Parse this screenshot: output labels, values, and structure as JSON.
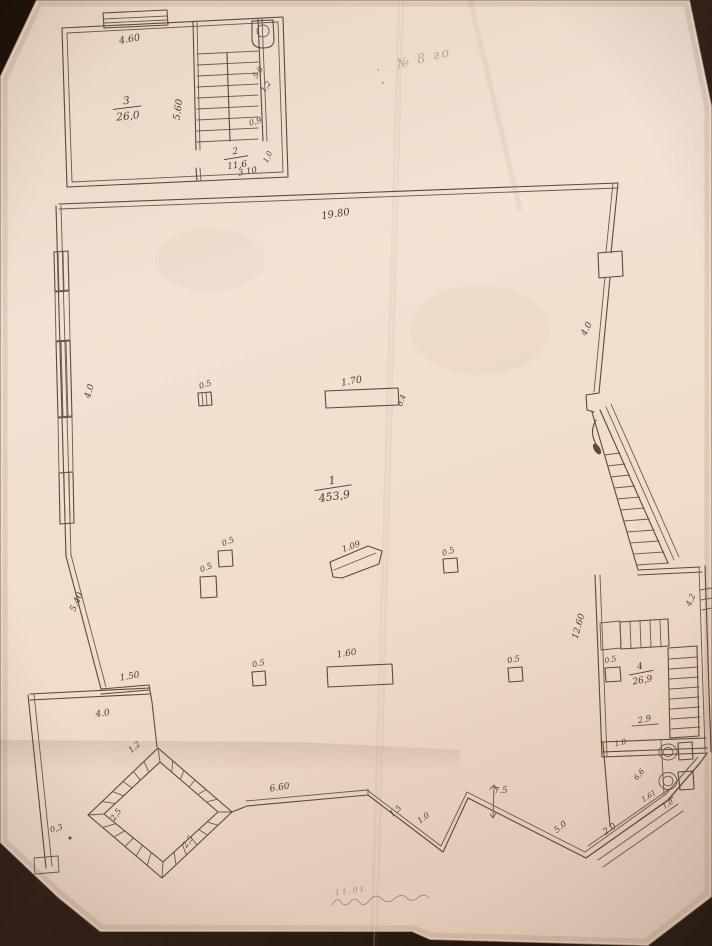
{
  "photo": {
    "background_color": "#281a11",
    "paper_color": "#eeddcd",
    "ink_color": "#5a493c",
    "pencil_color": "#4c3c30"
  },
  "rooms": [
    {
      "number": "3",
      "area": "26,0",
      "x": 127,
      "y": 107,
      "rot": -6,
      "size": 10.5
    },
    {
      "number": "2",
      "area": "11,6",
      "x": 236,
      "y": 157,
      "rot": -8,
      "size": 9
    },
    {
      "number": "1",
      "area": "453,9",
      "x": 333,
      "y": 487,
      "rot": -8,
      "size": 11
    },
    {
      "number": "4",
      "area": "26,9",
      "x": 641,
      "y": 672,
      "rot": -10,
      "size": 9
    }
  ],
  "dimensions": [
    {
      "text": "4.60",
      "x": 130,
      "y": 42,
      "rot": -10,
      "size": 9.5
    },
    {
      "text": "5.60",
      "x": 181,
      "y": 110,
      "rot": -82,
      "size": 9.5
    },
    {
      "text": "5,0",
      "x": 260,
      "y": 74,
      "rot": -55,
      "size": 7.5
    },
    {
      "text": "1,2",
      "x": 268,
      "y": 88,
      "rot": -55,
      "size": 7.5
    },
    {
      "text": "0,9",
      "x": 256,
      "y": 124,
      "rot": -18,
      "size": 8
    },
    {
      "text": "1,0",
      "x": 270,
      "y": 158,
      "rot": -65,
      "size": 7.5
    },
    {
      "text": "3.10",
      "x": 248,
      "y": 174,
      "rot": -10,
      "size": 8.5
    },
    {
      "text": "19.80",
      "x": 336,
      "y": 217,
      "rot": -9,
      "size": 10
    },
    {
      "text": "4.0",
      "x": 92,
      "y": 392,
      "rot": -74,
      "size": 9
    },
    {
      "text": "4.0",
      "x": 589,
      "y": 330,
      "rot": -64,
      "size": 9
    },
    {
      "text": "0.5",
      "x": 206,
      "y": 387,
      "rot": -18,
      "size": 8
    },
    {
      "text": "1.70",
      "x": 352,
      "y": 384,
      "rot": -10,
      "size": 9.5
    },
    {
      "text": "0.4",
      "x": 404,
      "y": 401,
      "rot": -74,
      "size": 7.5
    },
    {
      "text": "0.5",
      "x": 229,
      "y": 544,
      "rot": -22,
      "size": 8
    },
    {
      "text": "0.5",
      "x": 207,
      "y": 570,
      "rot": -22,
      "size": 8
    },
    {
      "text": "1.09",
      "x": 352,
      "y": 549,
      "rot": -20,
      "size": 8.5
    },
    {
      "text": "0.5",
      "x": 449,
      "y": 554,
      "rot": -18,
      "size": 8
    },
    {
      "text": "5.40",
      "x": 79,
      "y": 603,
      "rot": -66,
      "size": 9
    },
    {
      "text": "12.60",
      "x": 581,
      "y": 627,
      "rot": -74,
      "size": 9
    },
    {
      "text": "1.50",
      "x": 130,
      "y": 679,
      "rot": -10,
      "size": 9
    },
    {
      "text": "4.0",
      "x": 103,
      "y": 716,
      "rot": -8,
      "size": 9
    },
    {
      "text": "0.5",
      "x": 259,
      "y": 666,
      "rot": -12,
      "size": 8
    },
    {
      "text": "1.60",
      "x": 347,
      "y": 656,
      "rot": -9,
      "size": 9
    },
    {
      "text": "0.5",
      "x": 514,
      "y": 662,
      "rot": -10,
      "size": 8
    },
    {
      "text": "1,2",
      "x": 136,
      "y": 749,
      "rot": -40,
      "size": 8
    },
    {
      "text": "2,5",
      "x": 118,
      "y": 816,
      "rot": -55,
      "size": 8
    },
    {
      "text": "2,5",
      "x": 190,
      "y": 843,
      "rot": -55,
      "size": 8
    },
    {
      "text": "0,3",
      "x": 57,
      "y": 831,
      "rot": -15,
      "size": 8
    },
    {
      "text": "6.60",
      "x": 280,
      "y": 790,
      "rot": -9,
      "size": 9
    },
    {
      "text": "1.5",
      "x": 397,
      "y": 813,
      "rot": -38,
      "size": 8
    },
    {
      "text": "1.0",
      "x": 425,
      "y": 820,
      "rot": -36,
      "size": 8
    },
    {
      "text": "7.5",
      "x": 501,
      "y": 793,
      "rot": -5,
      "size": 8.5
    },
    {
      "text": "5.0",
      "x": 562,
      "y": 829,
      "rot": -40,
      "size": 8.5
    },
    {
      "text": "2.0",
      "x": 611,
      "y": 831,
      "rot": -36,
      "size": 8.5
    },
    {
      "text": "4,2",
      "x": 693,
      "y": 601,
      "rot": -66,
      "size": 8
    },
    {
      "text": "0.5",
      "x": 611,
      "y": 662,
      "rot": -12,
      "size": 7.5
    },
    {
      "text": "2.9",
      "x": 645,
      "y": 722,
      "rot": -12,
      "size": 8.5
    },
    {
      "text": "1.0",
      "x": 621,
      "y": 745,
      "rot": -14,
      "size": 7.5
    },
    {
      "text": "6,6",
      "x": 641,
      "y": 776,
      "rot": -50,
      "size": 7.5
    },
    {
      "text": "1,61",
      "x": 650,
      "y": 798,
      "rot": -32,
      "size": 7
    },
    {
      "text": "1,0",
      "x": 669,
      "y": 806,
      "rot": -32,
      "size": 7
    }
  ],
  "handwriting": [
    {
      "text": "№ 8 го",
      "x": 425,
      "y": 62,
      "rot": -14,
      "size": 13,
      "opacity": 0.42
    },
    {
      "text": "11.01",
      "x": 351,
      "y": 893,
      "rot": -8,
      "size": 7.5,
      "opacity": 0.6
    }
  ]
}
